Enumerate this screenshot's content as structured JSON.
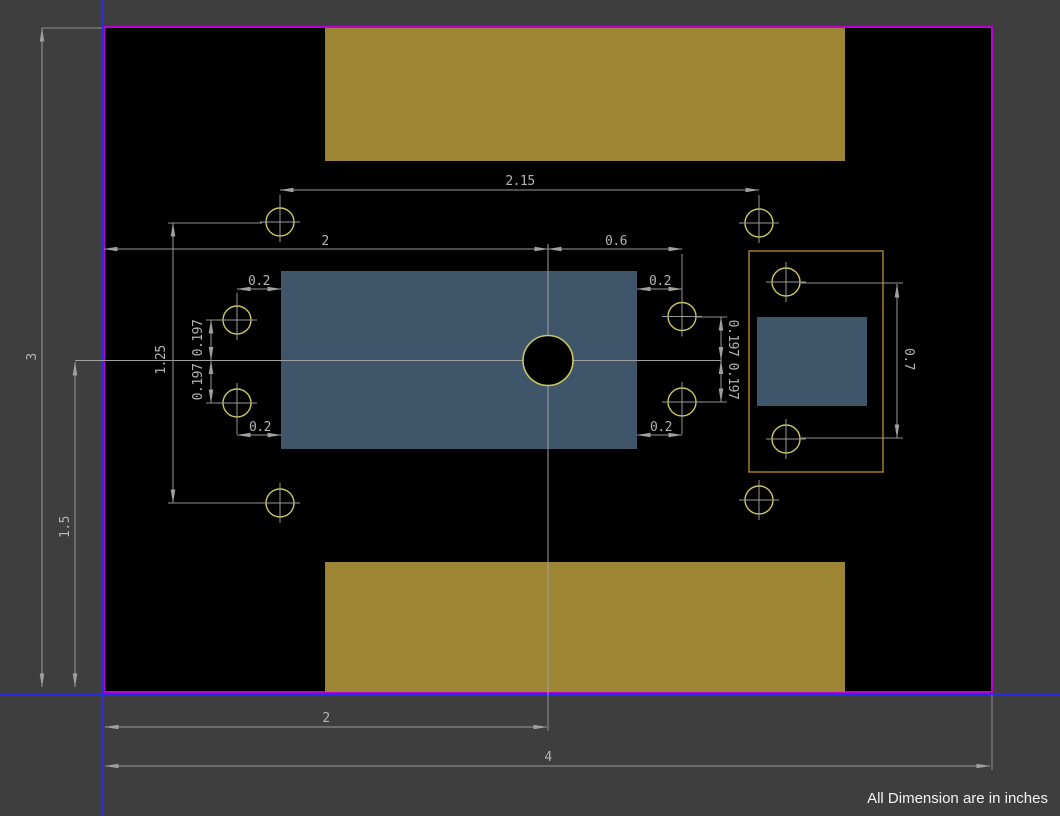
{
  "app": {
    "type": "pcb-cad-dimensioned-drawing",
    "units_note": "All Dimension are in inches"
  },
  "colors": {
    "background_gray": "#3e3e3e",
    "board_fill": "#000000",
    "board_outline_magenta": "#ba00d2",
    "origin_crosshair_blue": "#2b2be4",
    "copper_zone_olive": "#9c8634",
    "pad_steel_blue": "#3f566a",
    "hole_ring_yellow": "#c9c85f",
    "courtyard_outline_orange": "#a17e20",
    "dimension_gray": "#999999",
    "dimension_text_gray": "#b3b3b3",
    "note_text_white": "#f2f2f2"
  },
  "dims": {
    "board_width": "4",
    "board_height": "3",
    "center_from_left": "2",
    "center_from_bottom": "1.5",
    "top_hole_span": "2.15",
    "edge_to_center": "2",
    "center_to_side_hole": "0.6",
    "side_hole_offset": "0.2",
    "hole_pitch": "0.197",
    "left_hole_span": "1.25",
    "right_hole_span": "0.7"
  },
  "note": {
    "text": "All Dimension are in inches"
  }
}
